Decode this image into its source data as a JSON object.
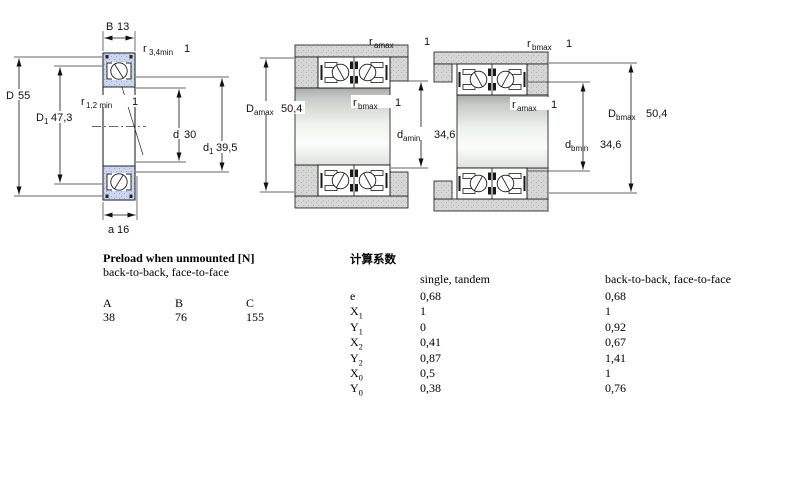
{
  "colors": {
    "ring_fill": "#ccd6ee",
    "ring_dot": "#93a7d4",
    "housing_fill": "#d7d7d7",
    "housing_dot": "#b2b2b2",
    "line": "#111111"
  },
  "bearing_view": {
    "B": {
      "sym": "B",
      "val": "13"
    },
    "r34": {
      "sym": "r",
      "sub": "3,4min",
      "val": "1"
    },
    "D": {
      "sym": "D",
      "val": "55"
    },
    "D1": {
      "sym": "D",
      "sub": "1",
      "val": "47,3"
    },
    "r12": {
      "sym": "r",
      "sub": "1,2 min",
      "val": "1"
    },
    "d": {
      "sym": "d",
      "val": "30"
    },
    "d1": {
      "sym": "d",
      "sub": "1",
      "val": "39,5"
    },
    "a": {
      "sym": "a",
      "val": "16"
    }
  },
  "arrangement_a": {
    "r_top": {
      "sym": "r",
      "sub": "amax",
      "val": "1"
    },
    "r_mid": {
      "sym": "r",
      "sub": "bmax",
      "val": "1"
    },
    "D": {
      "sym": "D",
      "sub": "amax",
      "val": "50,4"
    },
    "d": {
      "sym": "d",
      "sub": "amin",
      "val": "34,6"
    }
  },
  "arrangement_b": {
    "r_top": {
      "sym": "r",
      "sub": "bmax",
      "val": "1"
    },
    "r_mid": {
      "sym": "r",
      "sub": "amax",
      "val": "1"
    },
    "D": {
      "sym": "D",
      "sub": "bmax",
      "val": "50,4"
    },
    "d": {
      "sym": "d",
      "sub": "bmin",
      "val": "34,6"
    }
  },
  "preload_table": {
    "title": "Preload when unmounted [N]",
    "subtitle": "back-to-back, face-to-face",
    "columns": [
      "A",
      "B",
      "C"
    ],
    "values": [
      "38",
      "76",
      "155"
    ]
  },
  "factors_table": {
    "title": "计算系数",
    "col1": "single, tandem",
    "col2": "back-to-back, face-to-face",
    "rows": [
      {
        "sym": "e",
        "sub": "",
        "v1": "0,68",
        "v2": "0,68"
      },
      {
        "sym": "X",
        "sub": "1",
        "v1": "1",
        "v2": "1"
      },
      {
        "sym": "Y",
        "sub": "1",
        "v1": "0",
        "v2": "0,92"
      },
      {
        "sym": "X",
        "sub": "2",
        "v1": "0,41",
        "v2": "0,67"
      },
      {
        "sym": "Y",
        "sub": "2",
        "v1": "0,87",
        "v2": "1,41"
      },
      {
        "sym": "X",
        "sub": "0",
        "v1": "0,5",
        "v2": "1"
      },
      {
        "sym": "Y",
        "sub": "0",
        "v1": "0,38",
        "v2": "0,76"
      }
    ]
  }
}
